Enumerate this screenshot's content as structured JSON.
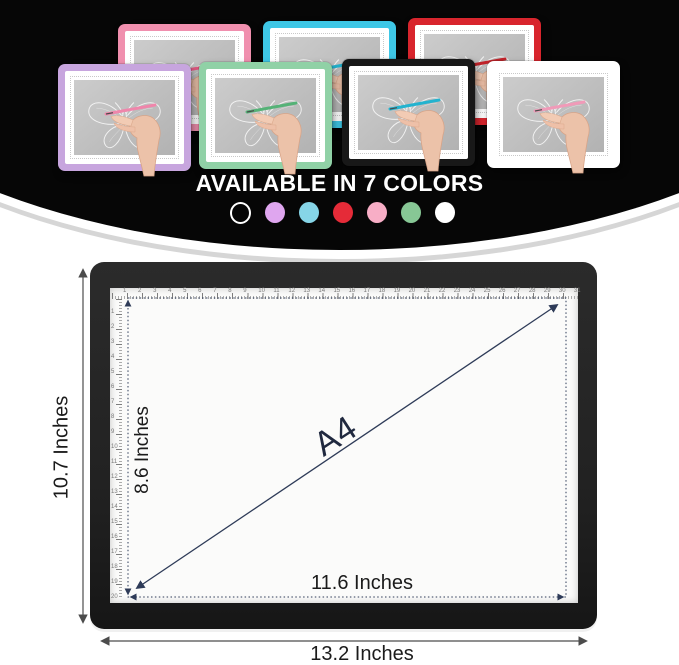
{
  "product": {
    "caption": "AVAILABLE IN 7 COLORS"
  },
  "hero": {
    "icons": [
      "butterfly-sketch",
      "hand-with-pen"
    ],
    "pads": [
      {
        "name": "pink",
        "frame_color": "#f08fae",
        "pen_color": "#e05a82"
      },
      {
        "name": "sky-blue",
        "frame_color": "#3ec7e6",
        "pen_color": "#23b3cf"
      },
      {
        "name": "red",
        "frame_color": "#d8252d",
        "pen_color": "#c2242b"
      },
      {
        "name": "lavender",
        "frame_color": "#c7a5de",
        "pen_color": "#ef86ab"
      },
      {
        "name": "mint-green",
        "frame_color": "#90d1a6",
        "pen_color": "#55b277"
      },
      {
        "name": "black",
        "frame_color": "#181818",
        "pen_color": "#23b3cf"
      },
      {
        "name": "white",
        "frame_color": "#ffffff",
        "pen_color": "#f09ab8"
      }
    ],
    "swatches": [
      {
        "name": "black-outline",
        "color": "transparent",
        "ring_color": "#ffffff"
      },
      {
        "name": "lavender",
        "color": "#dfa6ef"
      },
      {
        "name": "sky-blue",
        "color": "#86d5e7"
      },
      {
        "name": "red",
        "color": "#e52b38"
      },
      {
        "name": "pink",
        "color": "#f8aec6"
      },
      {
        "name": "green",
        "color": "#87c795"
      },
      {
        "name": "white",
        "color": "#ffffff"
      }
    ]
  },
  "diagram": {
    "outer_height_label": "10.7 Inches",
    "inner_height_label": "8.6 Inches",
    "inner_width_label": "11.6 Inches",
    "outer_width_label": "13.2 Inches",
    "area_label": "A4",
    "ruler": {
      "top_start": 1,
      "top_end": 31,
      "left_start": 1,
      "left_end": 20
    },
    "colors": {
      "dimension_line": "#2e3b58",
      "outer_dimension_line": "#4c4c4c",
      "pad_frame": "#222222",
      "screen": "#fbfbfa"
    }
  }
}
